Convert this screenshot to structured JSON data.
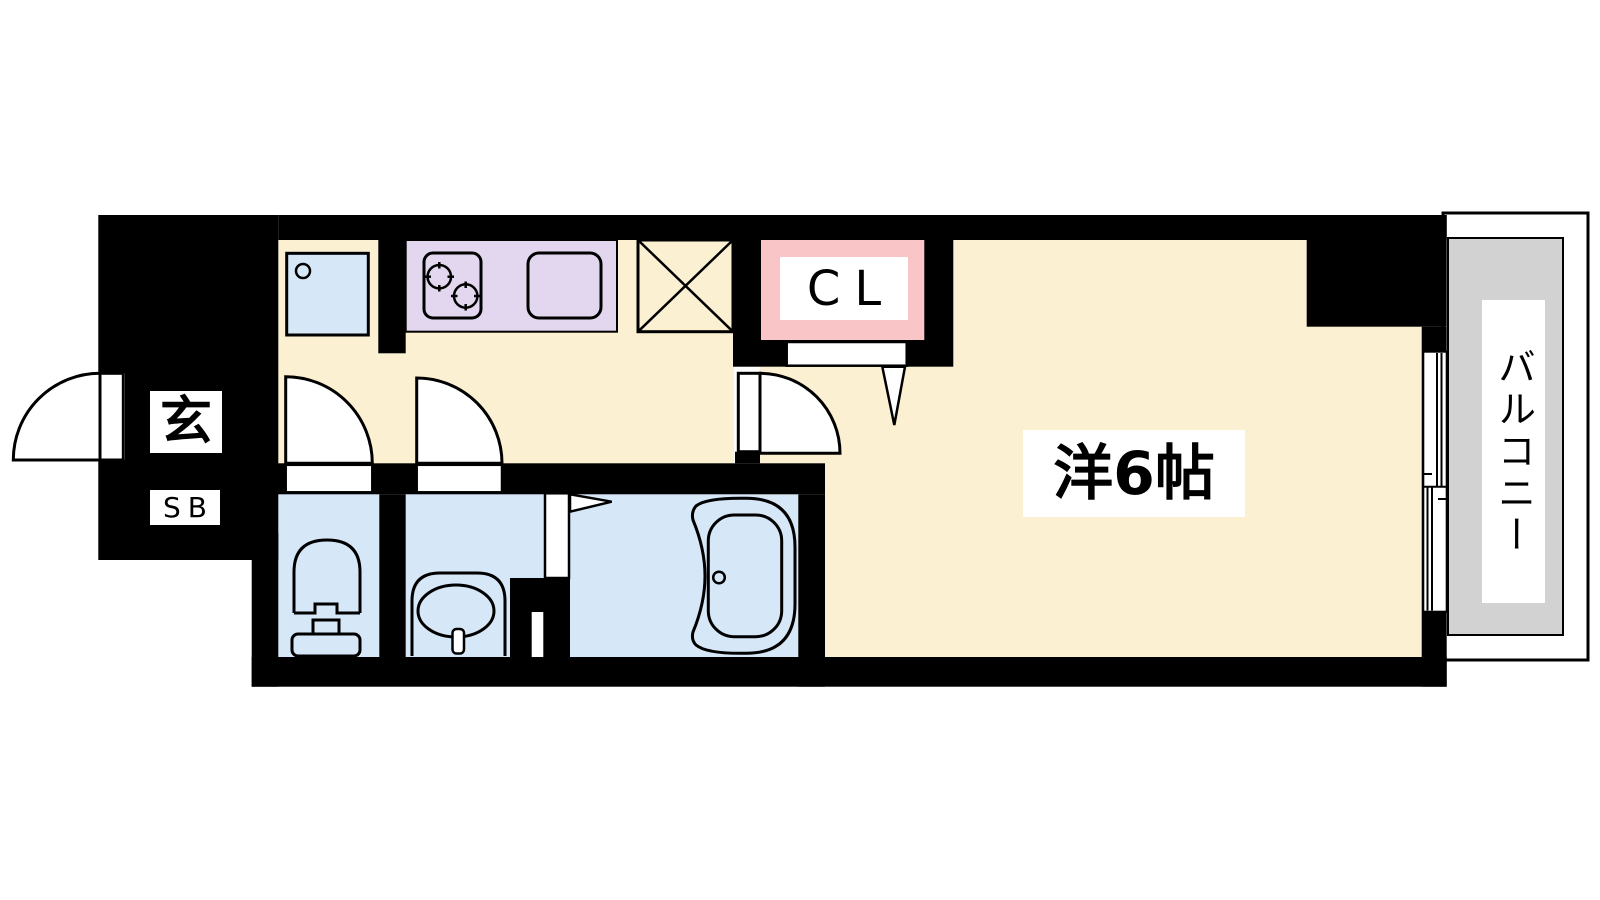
{
  "plan": {
    "type": "apartment-floorplan",
    "labels": {
      "entrance": "玄",
      "shoe_box": "SB",
      "closet": "CL",
      "main_room": "洋6帖",
      "balcony": "バルコニー"
    },
    "rooms": [
      {
        "name": "entrance-genkan",
        "label": "玄"
      },
      {
        "name": "shoe-box",
        "label": "SB"
      },
      {
        "name": "hallway-kitchen",
        "label": ""
      },
      {
        "name": "toilet-room",
        "label": ""
      },
      {
        "name": "washroom",
        "label": ""
      },
      {
        "name": "bathroom",
        "label": ""
      },
      {
        "name": "closet",
        "label": "CL"
      },
      {
        "name": "western-room-6jo",
        "label": "洋6帖"
      },
      {
        "name": "balcony",
        "label": "バルコニー"
      }
    ],
    "fixtures": [
      "entrance-door",
      "toilet-door",
      "washroom-door",
      "room-door",
      "closet-door",
      "folding-door",
      "sliding-window",
      "washing-machine-pan",
      "stove",
      "kitchen-sink",
      "refrigerator-space",
      "toilet",
      "washbasin",
      "bathtub"
    ]
  },
  "colors": {
    "bg": "#FFFFFF",
    "wall": "#000000",
    "floor-cream": "#FBF0D2",
    "wet-blue": "#D6E7F8",
    "counter-purple": "#E3D7EF",
    "accent-pink": "#FAC5C7",
    "genkan-gray": "#C9C9C9",
    "balcony-gray": "#D2D2D2",
    "line": "#000000"
  }
}
